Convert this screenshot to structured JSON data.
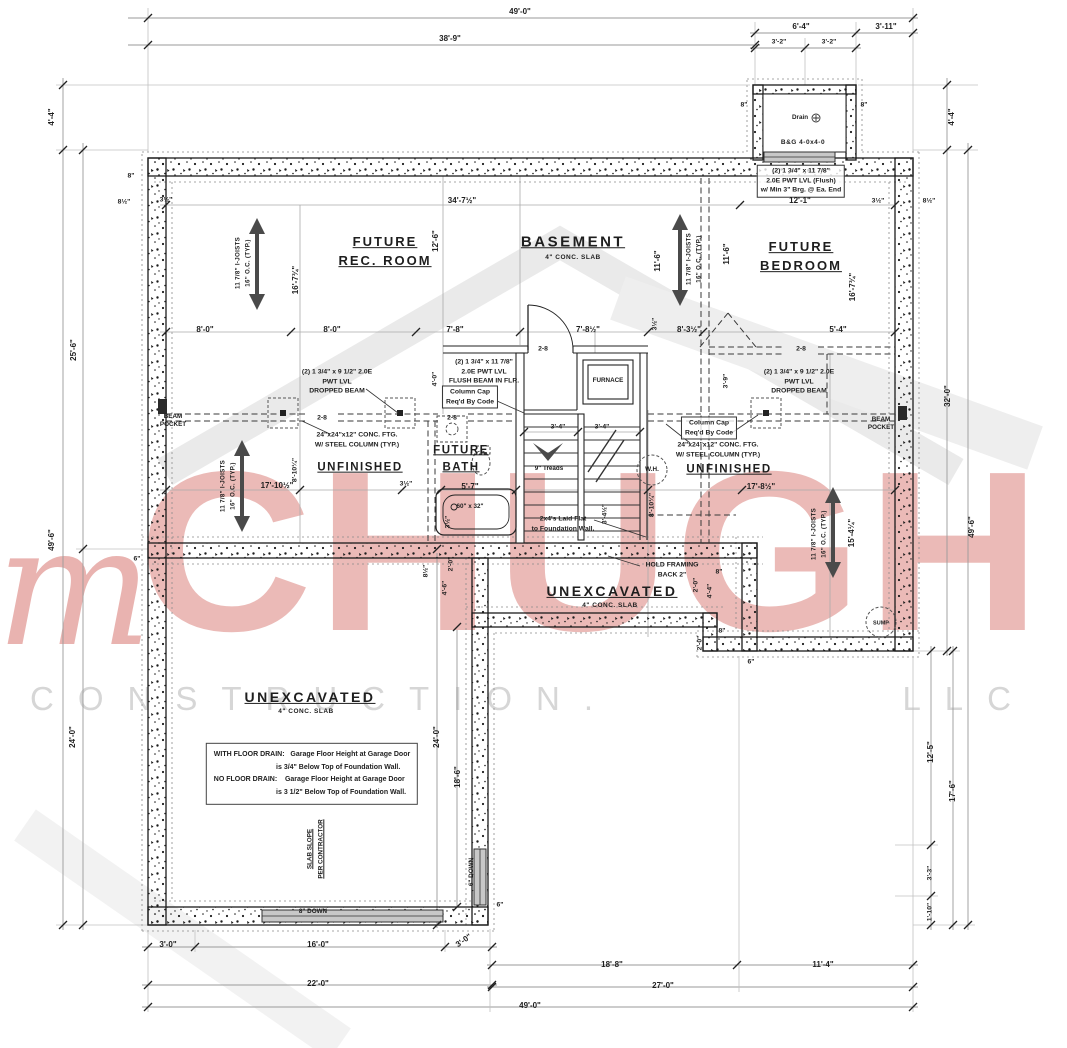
{
  "watermark": {
    "script_m": "m",
    "name": "CHUGH",
    "tagline_left": "CONSTRUCTION.",
    "tagline_right": "LLC",
    "red": "#ca4a42",
    "gray": "#d6d6d6"
  },
  "labels": [
    {
      "t": "49'-0\"",
      "x": 520,
      "y": 12,
      "n": "dim-overall-width-top"
    },
    {
      "t": "38'-9\"",
      "x": 450,
      "y": 39
    },
    {
      "t": "6'-4\"",
      "x": 801,
      "y": 27
    },
    {
      "t": "3'-11\"",
      "x": 886,
      "y": 27
    },
    {
      "t": "3'-2\"",
      "x": 779,
      "y": 43,
      "c": "dimS"
    },
    {
      "t": "3'-2\"",
      "x": 829,
      "y": 43,
      "c": "dimS"
    },
    {
      "t": "8\"",
      "x": 744,
      "y": 106,
      "c": "dimS"
    },
    {
      "t": "8\"",
      "x": 864,
      "y": 106,
      "c": "dimS"
    },
    {
      "t": "Drain",
      "x": 800,
      "y": 118,
      "c": "tiny",
      "n": "drain-label"
    },
    {
      "t": "B&G 4-0x4-0",
      "x": 803,
      "y": 143,
      "c": "sub",
      "n": "egress-window-label"
    },
    {
      "t": "(2) 1 3/4\" x 11 7/8\"\n2.0E PWT LVL (Flush)\nw/ Min 3\" Brg. @ Ea. End",
      "x": 801,
      "y": 181,
      "c": "noteB",
      "n": "lvl-flush-note"
    },
    {
      "t": "12'-1\"",
      "x": 800,
      "y": 201
    },
    {
      "t": "3½\"",
      "x": 878,
      "y": 202,
      "c": "dimS"
    },
    {
      "t": "8½\"",
      "x": 929,
      "y": 202,
      "c": "dimS"
    },
    {
      "t": "8\"",
      "x": 131,
      "y": 177,
      "c": "dimS"
    },
    {
      "t": "8½\"",
      "x": 124,
      "y": 203,
      "c": "dimS"
    },
    {
      "t": "3½\"",
      "x": 166,
      "y": 201,
      "c": "dimS"
    },
    {
      "t": "34'-7½\"",
      "x": 462,
      "y": 201
    },
    {
      "t": "4'-4\"",
      "x": 52,
      "y": 117,
      "r": -90
    },
    {
      "t": "25'-6\"",
      "x": 74,
      "y": 350,
      "r": -90
    },
    {
      "t": "49'-6\"",
      "x": 52,
      "y": 540,
      "r": -90
    },
    {
      "t": "24'-0\"",
      "x": 73,
      "y": 737,
      "r": -90
    },
    {
      "t": "6\"",
      "x": 137,
      "y": 560,
      "c": "dimS"
    },
    {
      "t": "4'-4\"",
      "x": 952,
      "y": 117,
      "r": -90
    },
    {
      "t": "32'-0\"",
      "x": 948,
      "y": 396,
      "r": -90
    },
    {
      "t": "49'-6\"",
      "x": 972,
      "y": 527,
      "r": -90
    },
    {
      "t": "12'-5\"",
      "x": 931,
      "y": 752,
      "r": -90
    },
    {
      "t": "17'-6\"",
      "x": 953,
      "y": 791,
      "r": -90
    },
    {
      "t": "3'-3\"",
      "x": 931,
      "y": 873,
      "r": -90,
      "c": "dimS"
    },
    {
      "t": "1'-10\"",
      "x": 931,
      "y": 912,
      "r": -90,
      "c": "dimS"
    },
    {
      "t": "3'-0\"",
      "x": 168,
      "y": 945
    },
    {
      "t": "16'-0\"",
      "x": 318,
      "y": 945
    },
    {
      "t": "3'-0\"",
      "x": 464,
      "y": 941,
      "r": -35
    },
    {
      "t": "22'-0\"",
      "x": 318,
      "y": 984
    },
    {
      "t": "49'-0\"",
      "x": 530,
      "y": 1006,
      "n": "dim-overall-width-bottom"
    },
    {
      "t": "18'-8\"",
      "x": 612,
      "y": 965
    },
    {
      "t": "11'-4\"",
      "x": 823,
      "y": 965
    },
    {
      "t": "27'-0\"",
      "x": 663,
      "y": 986
    },
    {
      "t": "6\"",
      "x": 500,
      "y": 906,
      "c": "dimS"
    },
    {
      "t": "FUTURE\nREC. ROOM",
      "x": 385,
      "y": 252,
      "c": "room",
      "n": "room-label-future-rec-room"
    },
    {
      "t": "BASEMENT",
      "x": 573,
      "y": 242,
      "c": "roomL",
      "n": "room-label-basement"
    },
    {
      "t": "4\" CONC. SLAB",
      "x": 573,
      "y": 258,
      "c": "sub"
    },
    {
      "t": "FUTURE\nBEDROOM",
      "x": 801,
      "y": 257,
      "c": "room",
      "n": "room-label-future-bedroom"
    },
    {
      "t": "FUTURE\nBATH",
      "x": 461,
      "y": 459,
      "c": "roomS",
      "n": "room-label-future-bath"
    },
    {
      "t": "UNFINISHED",
      "x": 360,
      "y": 468,
      "c": "roomS",
      "n": "room-label-unfinished-left"
    },
    {
      "t": "UNFINISHED",
      "x": 729,
      "y": 470,
      "c": "roomS",
      "n": "room-label-unfinished-right"
    },
    {
      "t": "UNEXCAVATED",
      "x": 612,
      "y": 591,
      "c": "roomM",
      "n": "room-label-unexcavated-strip"
    },
    {
      "t": "4\" CONC. SLAB",
      "x": 610,
      "y": 606,
      "c": "sub"
    },
    {
      "t": "UNEXCAVATED",
      "x": 310,
      "y": 697,
      "c": "roomM",
      "n": "room-label-unexcavated-garage"
    },
    {
      "t": "4\" CONC. SLAB",
      "x": 306,
      "y": 712,
      "c": "sub"
    },
    {
      "t": "8'-0\"",
      "x": 205,
      "y": 330
    },
    {
      "t": "8'-0\"",
      "x": 332,
      "y": 330
    },
    {
      "t": "7'-8\"",
      "x": 455,
      "y": 330
    },
    {
      "t": "7'-8½\"",
      "x": 588,
      "y": 330
    },
    {
      "t": "3½\"",
      "x": 656,
      "y": 324,
      "r": -90,
      "c": "dimS"
    },
    {
      "t": "8'-3½\"",
      "x": 689,
      "y": 330
    },
    {
      "t": "5'-4\"",
      "x": 838,
      "y": 330
    },
    {
      "t": "12'-6\"",
      "x": 436,
      "y": 241,
      "r": -90
    },
    {
      "t": "11'-6\"",
      "x": 658,
      "y": 261,
      "r": -90
    },
    {
      "t": "11'-6\"",
      "x": 727,
      "y": 254,
      "r": -90
    },
    {
      "t": "16'-7¾\"",
      "x": 296,
      "y": 280,
      "r": -90
    },
    {
      "t": "16'-7¾\"",
      "x": 853,
      "y": 287,
      "r": -90
    },
    {
      "t": "11 7/8\" I-JOISTS\n16\" O.C. (TYP.)",
      "x": 243,
      "y": 263,
      "r": -90,
      "c": "jt",
      "n": "joist-note"
    },
    {
      "t": "11 7/8\" I-JOISTS\n16\" O.C. (TYP.)",
      "x": 694,
      "y": 259,
      "r": -90,
      "c": "jt",
      "n": "joist-note"
    },
    {
      "t": "11 7/8\" I-JOISTS\n16\" O.C. (TYP.)",
      "x": 228,
      "y": 486,
      "r": -90,
      "c": "jt",
      "n": "joist-note"
    },
    {
      "t": "11 7/8\" I-JOISTS\n16\" O.C. (TYP.)",
      "x": 819,
      "y": 534,
      "r": -90,
      "c": "jt",
      "n": "joist-note"
    },
    {
      "t": "15'-4¼\"",
      "x": 852,
      "y": 533,
      "r": -90
    },
    {
      "t": "(2) 1 3/4\" x 9 1/2\" 2.0E\nPWT LVL\nDROPPED BEAM",
      "x": 337,
      "y": 382,
      "c": "note",
      "n": "dropped-beam-note-left"
    },
    {
      "t": "(2) 1 3/4\" x 11 7/8\"\n2.0E PWT LVL\nFLUSH BEAM IN FLR.",
      "x": 484,
      "y": 372,
      "c": "note",
      "n": "flush-beam-note"
    },
    {
      "t": "(2) 1 3/4\" x 9 1/2\" 2.0E\nPWT LVL\nDROPPED BEAM",
      "x": 799,
      "y": 382,
      "c": "note",
      "n": "dropped-beam-note-right"
    },
    {
      "t": "Column Cap\nReq'd By Code",
      "x": 470,
      "y": 397,
      "c": "noteB",
      "n": "column-cap-note-left"
    },
    {
      "t": "Column Cap\nReq'd By Code",
      "x": 709,
      "y": 428,
      "c": "noteB",
      "n": "column-cap-note-right"
    },
    {
      "t": "24\"x24\"x12\" CONC. FTG.\nW/ STEEL COLUMN (TYP.)",
      "x": 357,
      "y": 440,
      "c": "note",
      "n": "footing-note-left"
    },
    {
      "t": "24\"x24\"x12\" CONC. FTG.\nW/ STEEL COLUMN (TYP.)",
      "x": 718,
      "y": 450,
      "c": "note",
      "n": "footing-note-right"
    },
    {
      "t": "BEAM\nPOCKET",
      "x": 173,
      "y": 421,
      "c": "tiny",
      "n": "beam-pocket-label-left"
    },
    {
      "t": "BEAM\nPOCKET",
      "x": 881,
      "y": 424,
      "c": "tiny",
      "n": "beam-pocket-label-right"
    },
    {
      "t": "4'-0\"",
      "x": 436,
      "y": 379,
      "r": -90,
      "c": "dimS"
    },
    {
      "t": "2-8",
      "x": 322,
      "y": 419,
      "c": "dimS"
    },
    {
      "t": "2-8",
      "x": 452,
      "y": 419,
      "c": "dimS"
    },
    {
      "t": "2-8",
      "x": 543,
      "y": 350,
      "c": "dimS"
    },
    {
      "t": "2-8",
      "x": 801,
      "y": 350,
      "c": "dimS"
    },
    {
      "t": "3'-9\"",
      "x": 727,
      "y": 381,
      "r": -90,
      "c": "dimS"
    },
    {
      "t": "FURNACE",
      "x": 608,
      "y": 381,
      "c": "tiny",
      "n": "furnace-label"
    },
    {
      "t": "3'-4\"",
      "x": 558,
      "y": 428,
      "c": "dimS"
    },
    {
      "t": "3'-4\"",
      "x": 602,
      "y": 428,
      "c": "dimS"
    },
    {
      "t": "9\" Treads",
      "x": 549,
      "y": 469,
      "c": "tiny",
      "n": "stair-treads-label"
    },
    {
      "t": "W.H.",
      "x": 652,
      "y": 470,
      "c": "tiny",
      "n": "water-heater-label"
    },
    {
      "t": "2x4's Laid Flat\nto Foundation Wall.",
      "x": 563,
      "y": 524,
      "c": "note",
      "n": "plate-note"
    },
    {
      "t": "3'-4½\"",
      "x": 606,
      "y": 514,
      "r": -90,
      "c": "dimS"
    },
    {
      "t": "8'-10¼\"",
      "x": 653,
      "y": 505,
      "r": -90,
      "c": "dimS"
    },
    {
      "t": "8'-10¼\"",
      "x": 296,
      "y": 470,
      "r": -90,
      "c": "dimS"
    },
    {
      "t": "17'-10½\"",
      "x": 277,
      "y": 486
    },
    {
      "t": "3½\"",
      "x": 406,
      "y": 485,
      "c": "dimS"
    },
    {
      "t": "5'-7\"",
      "x": 470,
      "y": 487
    },
    {
      "t": "17'-8½\"",
      "x": 761,
      "y": 487
    },
    {
      "t": "60\" x 32\"",
      "x": 470,
      "y": 507,
      "c": "tiny",
      "n": "tub-size-label"
    },
    {
      "t": "3½\"",
      "x": 449,
      "y": 522,
      "r": -90,
      "c": "dimS"
    },
    {
      "t": "HOLD FRAMING\nBACK 2\"",
      "x": 672,
      "y": 570,
      "c": "note",
      "n": "hold-framing-note"
    },
    {
      "t": "8\"",
      "x": 719,
      "y": 573,
      "c": "dimS"
    },
    {
      "t": "8\"",
      "x": 722,
      "y": 632,
      "c": "dimS"
    },
    {
      "t": "2'-0\"",
      "x": 697,
      "y": 585,
      "r": -90,
      "c": "dimS"
    },
    {
      "t": "4'-4\"",
      "x": 711,
      "y": 591,
      "r": -90,
      "c": "dimS"
    },
    {
      "t": "2'-0\"",
      "x": 701,
      "y": 643,
      "r": -90,
      "c": "dimS"
    },
    {
      "t": "SUMP",
      "x": 881,
      "y": 624,
      "c": "tiny5",
      "n": "sump-label"
    },
    {
      "t": "6\"",
      "x": 751,
      "y": 663,
      "c": "dimS"
    },
    {
      "t": "8½\"",
      "x": 427,
      "y": 571,
      "r": -90,
      "c": "dimS"
    },
    {
      "t": "2'-0\"",
      "x": 452,
      "y": 564,
      "r": -90,
      "c": "dimS"
    },
    {
      "t": "4'-6\"",
      "x": 446,
      "y": 588,
      "r": -90,
      "c": "dimS"
    },
    {
      "t": "WITH FLOOR DRAIN:   Garage Floor Height at Garage Door\n                                is 3/4\" Below Top of Foundation Wall.\nNO FLOOR DRAIN:    Garage Floor Height at Garage Door\n                                is 3 1/2\" Below Top of Foundation Wall.",
      "x": 312,
      "y": 774,
      "c": "gnote",
      "n": "garage-floor-note"
    },
    {
      "t": "24'-0\"",
      "x": 437,
      "y": 737,
      "r": -90
    },
    {
      "t": "18'-6\"",
      "x": 458,
      "y": 777,
      "r": -90
    },
    {
      "t": "SLAB SLOPE\nPER CONTRACTOR",
      "x": 316,
      "y": 849,
      "r": -90,
      "c": "tinyU",
      "n": "slab-slope-note"
    },
    {
      "t": "8\" DOWN",
      "x": 313,
      "y": 912,
      "c": "tiny",
      "n": "step-down-label-bottom"
    },
    {
      "t": "6\" DOWN",
      "x": 472,
      "y": 872,
      "r": -90,
      "c": "tiny",
      "n": "step-down-label-side"
    }
  ]
}
